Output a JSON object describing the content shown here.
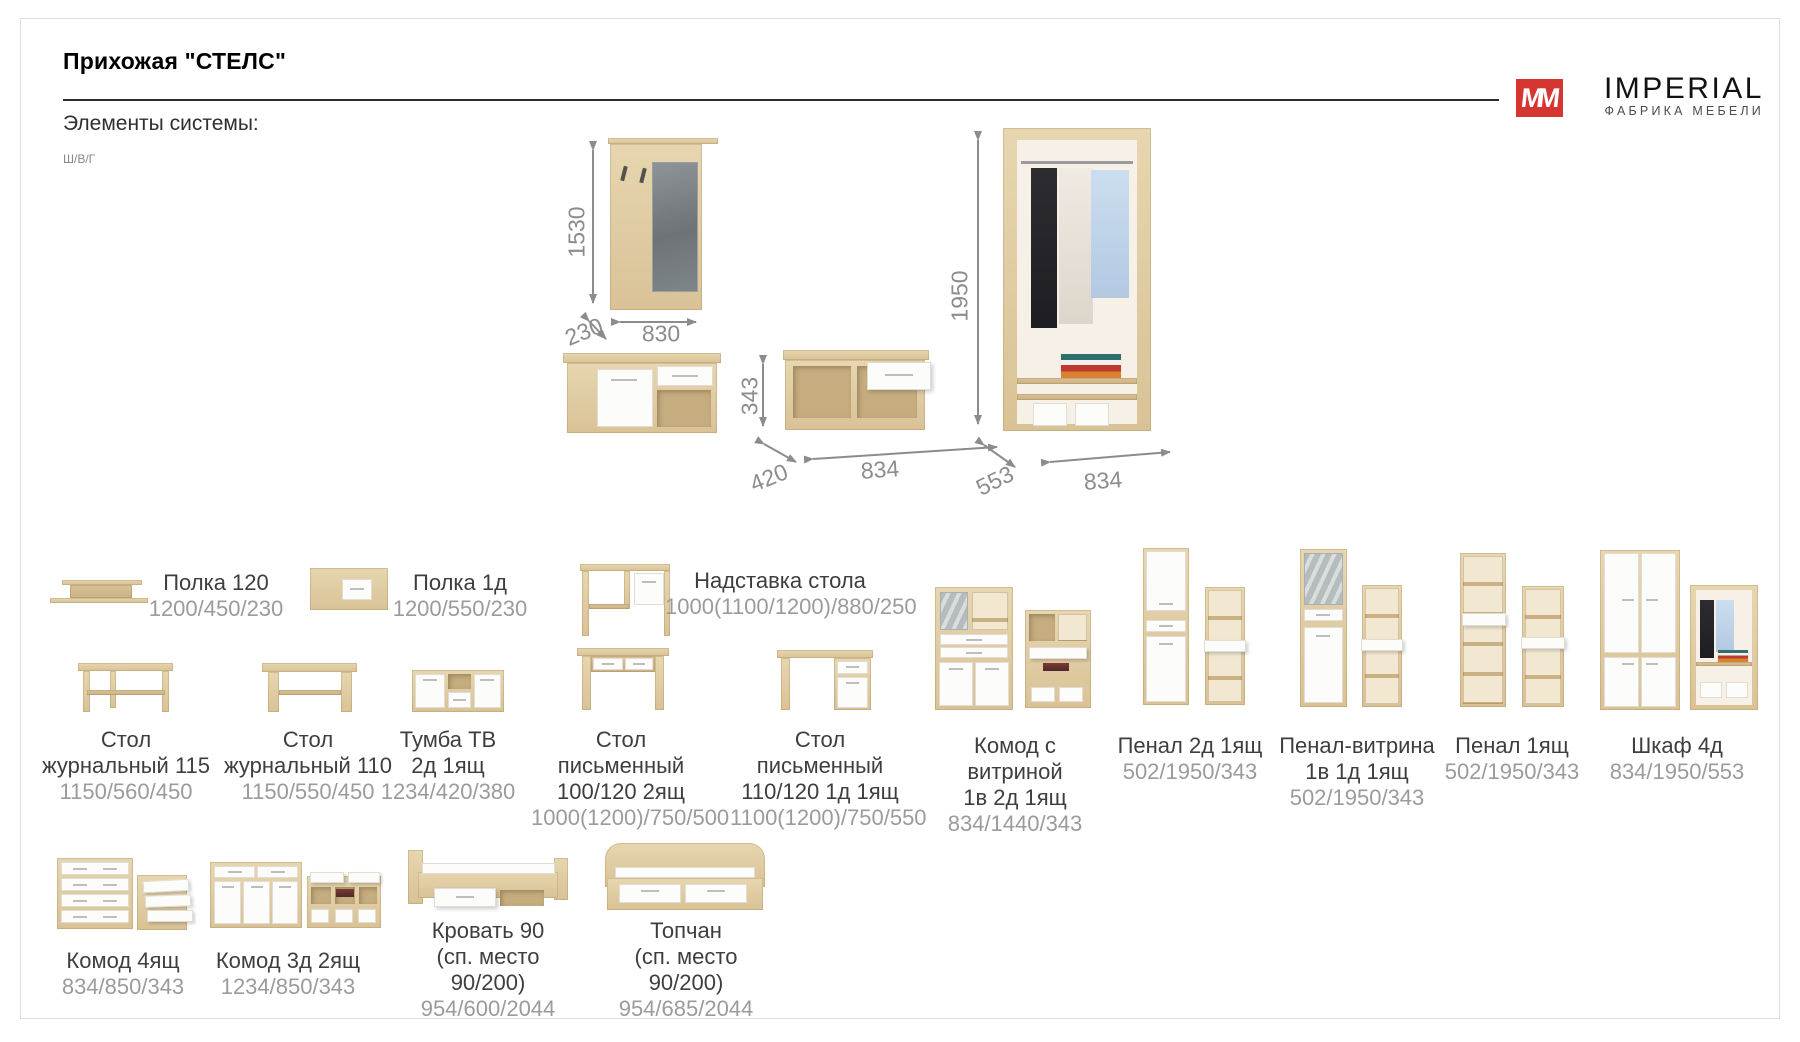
{
  "page": {
    "title": "Прихожая \"СТЕЛС\"",
    "section_heading": "Элементы системы:",
    "dims_legend": "Ш/В/Г"
  },
  "brand": {
    "logo_letters": "MM",
    "name": "IMPERIAL",
    "tagline": "ФАБРИКА МЕБЕЛИ",
    "accent_color": "#d63631"
  },
  "diagrams": {
    "mirror_hanger": {
      "height": "1530",
      "depth": "230",
      "width": "830"
    },
    "bench": {
      "height": "343",
      "depth": "420",
      "width": "834"
    },
    "wardrobe": {
      "height": "1950",
      "depth": "553",
      "width": "834"
    }
  },
  "products": [
    {
      "line1": "Полка 120",
      "line2": "",
      "dims": "1200/450/230"
    },
    {
      "line1": "Полка 1д",
      "line2": "",
      "dims": "1200/550/230"
    },
    {
      "line1": "Надставка стола",
      "line2": "",
      "dims": "1000(1100/1200)/880/250"
    },
    {
      "line1": "Комод с витриной",
      "line2": "1в 2д 1ящ",
      "dims": "834/1440/343"
    },
    {
      "line1": "Пенал 2д 1ящ",
      "line2": "",
      "dims": "502/1950/343"
    },
    {
      "line1": "Пенал-витрина",
      "line2": "1в 1д 1ящ",
      "dims": "502/1950/343"
    },
    {
      "line1": "Пенал 1ящ",
      "line2": "",
      "dims": "502/1950/343"
    },
    {
      "line1": "Шкаф 4д",
      "line2": "",
      "dims": "834/1950/553"
    },
    {
      "line1": "Стол",
      "line2": "журнальный 115",
      "dims": "1150/560/450"
    },
    {
      "line1": "Стол",
      "line2": "журнальный 110",
      "dims": "1150/550/450"
    },
    {
      "line1": "Тумба ТВ",
      "line2": "2д 1ящ",
      "dims": "1234/420/380"
    },
    {
      "line1": "Стол письменный",
      "line2": "100/120 2ящ",
      "dims": "1000(1200)/750/500"
    },
    {
      "line1": "Стол письменный",
      "line2": "110/120 1д 1ящ",
      "dims": "1100(1200)/750/550"
    },
    {
      "line1": "Комод 4ящ",
      "line2": "",
      "dims": "834/850/343"
    },
    {
      "line1": "Комод 3д 2ящ",
      "line2": "",
      "dims": "1234/850/343"
    },
    {
      "line1": "Кровать 90",
      "line2": "(сп. место 90/200)",
      "dims": "954/600/2044"
    },
    {
      "line1": "Топчан",
      "line2": "(сп. место 90/200)",
      "dims": "954/685/2044"
    }
  ]
}
